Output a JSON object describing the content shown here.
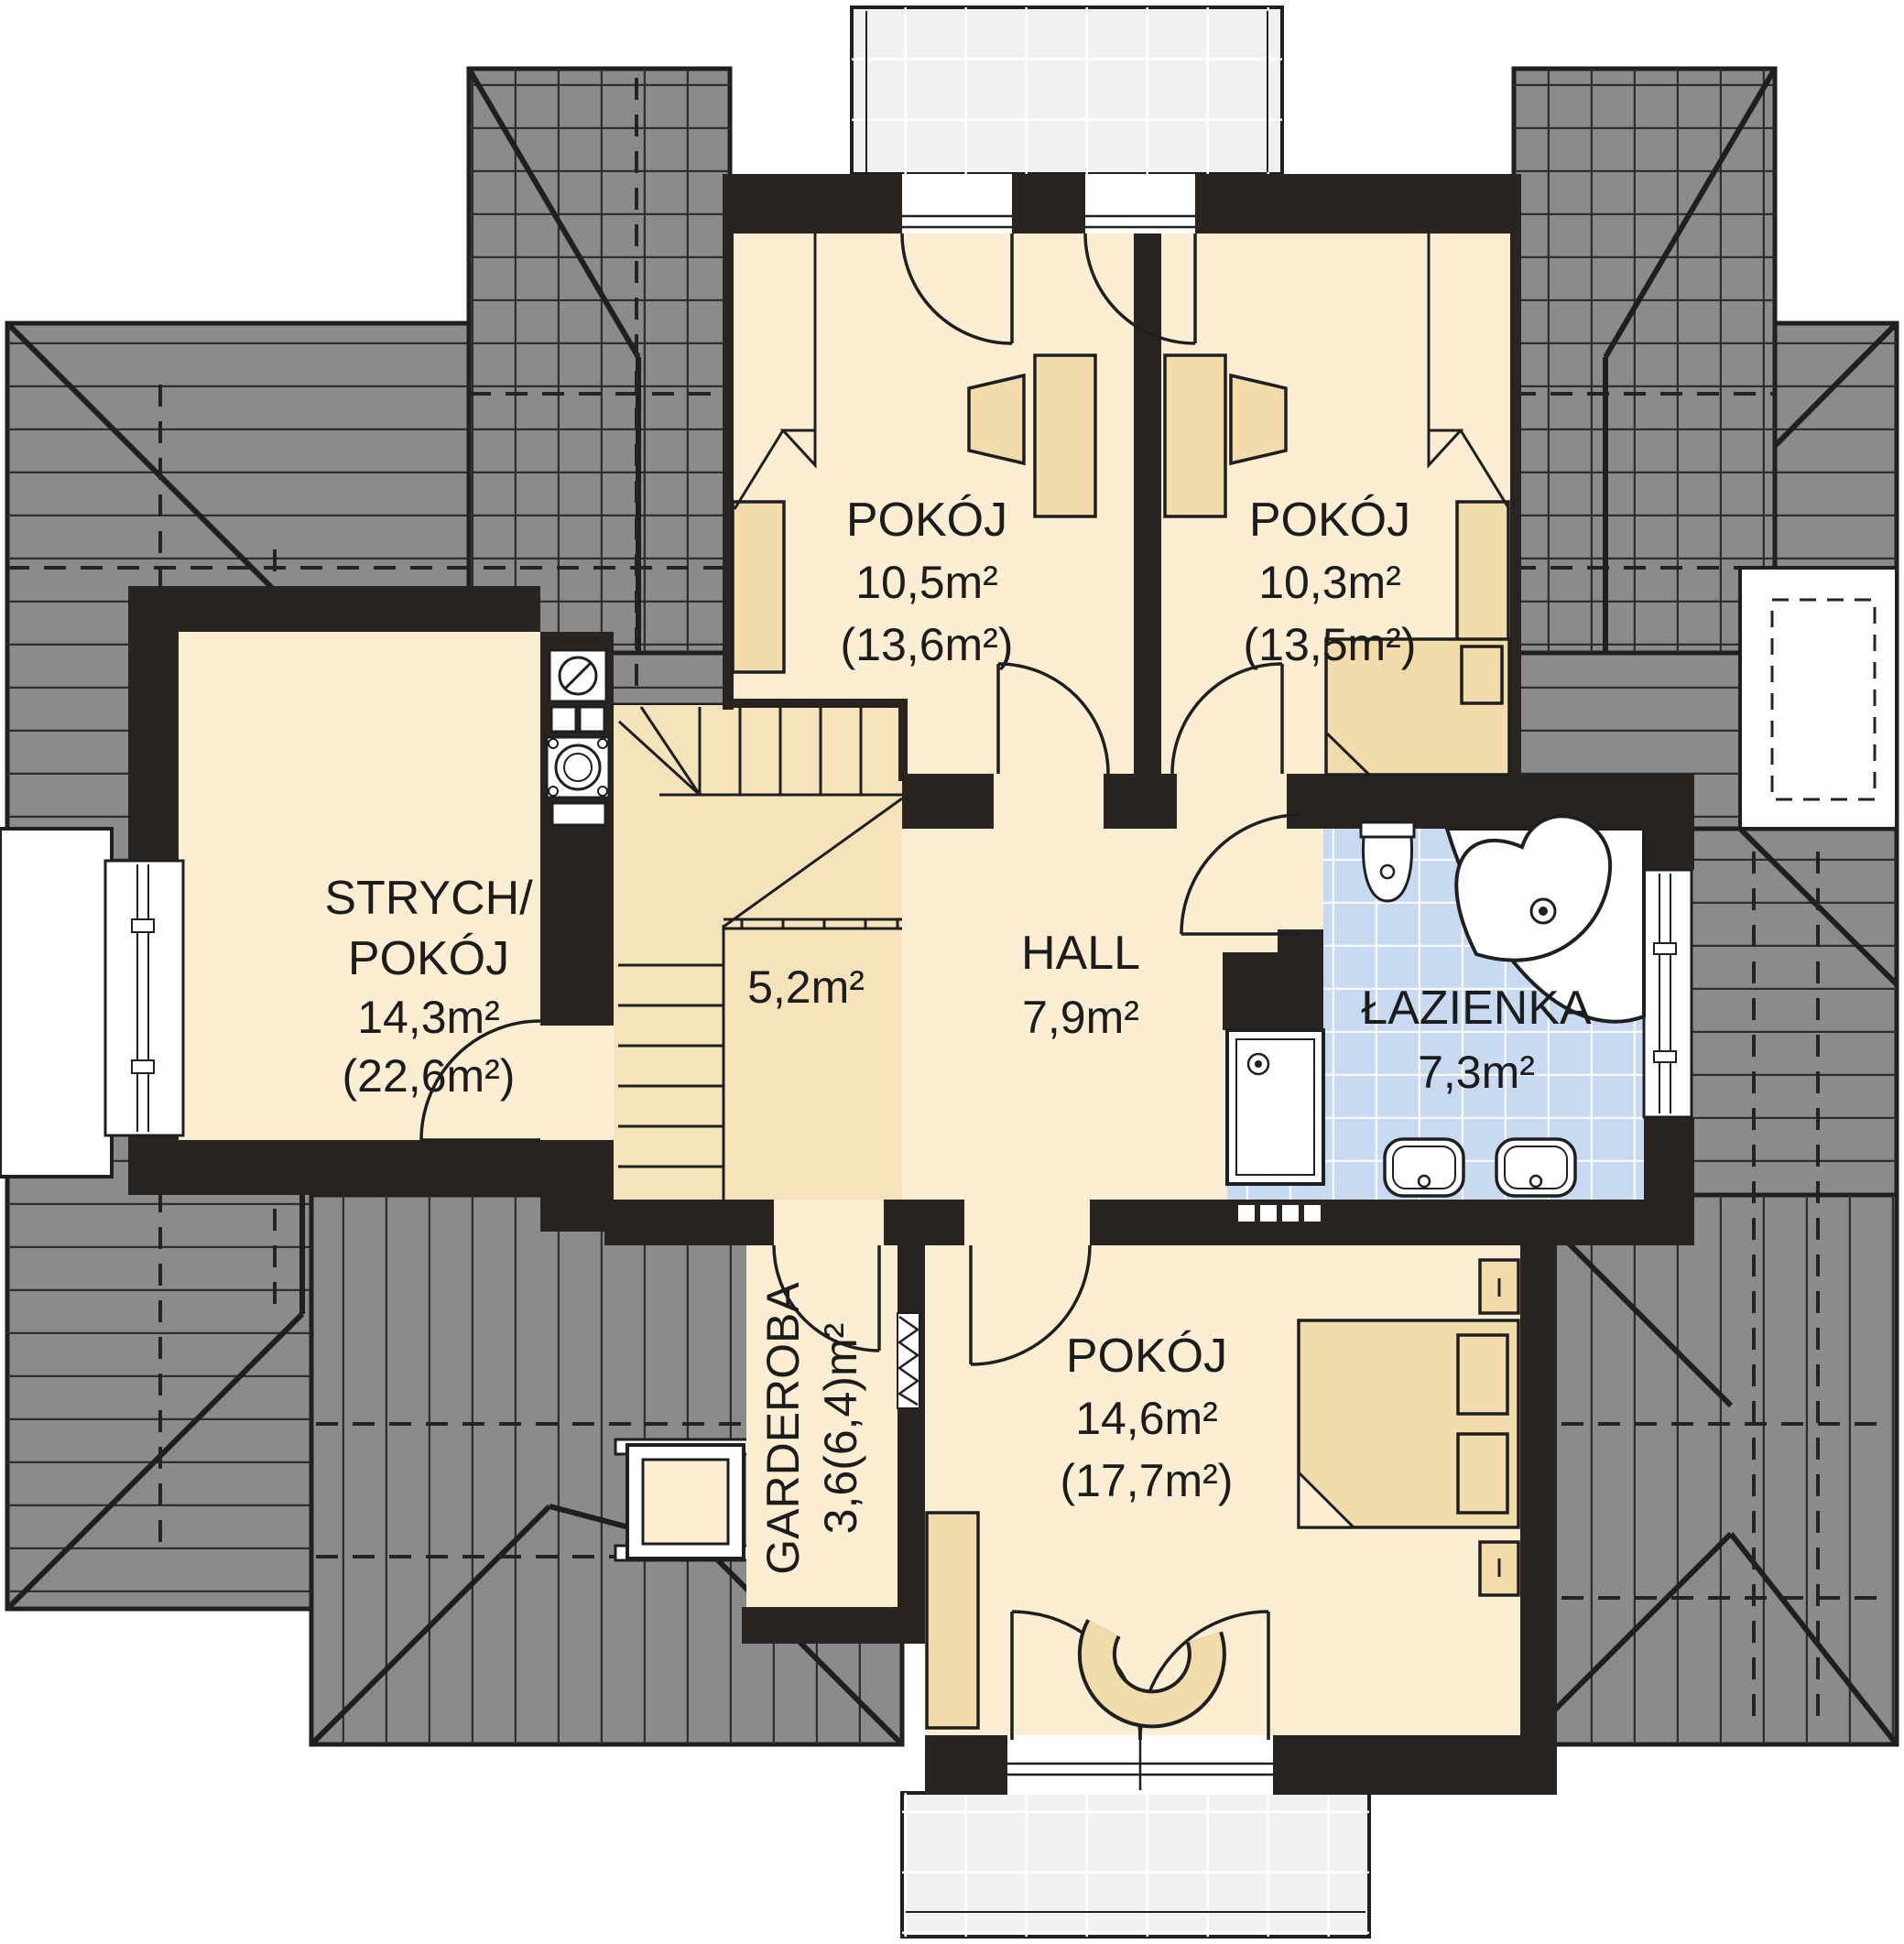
{
  "labels": {
    "room1": {
      "name": "POKÓJ",
      "area": "10,5m²",
      "area_total": "(13,6m²)"
    },
    "room2": {
      "name": "POKÓJ",
      "area": "10,3m²",
      "area_total": "(13,5m²)"
    },
    "attic": {
      "name1": "STRYCH/",
      "name2": "POKÓJ",
      "area": "14,3m²",
      "area_total": "(22,6m²)"
    },
    "stairs": {
      "area": "5,2m²"
    },
    "hall": {
      "name": "HALL",
      "area": "7,9m²"
    },
    "bathroom": {
      "name": "ŁAZIENKA",
      "area": "7,3m²"
    },
    "wardrobe": {
      "name": "GARDEROBA",
      "area": "3,6(6,4)m²"
    },
    "room3": {
      "name": "POKÓJ",
      "area": "14,6m²",
      "area_total": "(17,7m²)"
    }
  },
  "colors": {
    "wall": "#2A2421",
    "roof": "#8B8B8B",
    "floor": "#FBEED3",
    "stairs_floor": "#F6E3BC",
    "furniture": "#F3DCAC",
    "bathroom_tile": "#C7DAF2",
    "terrace": "#F1F1F3",
    "line": "#1f1f1f"
  }
}
